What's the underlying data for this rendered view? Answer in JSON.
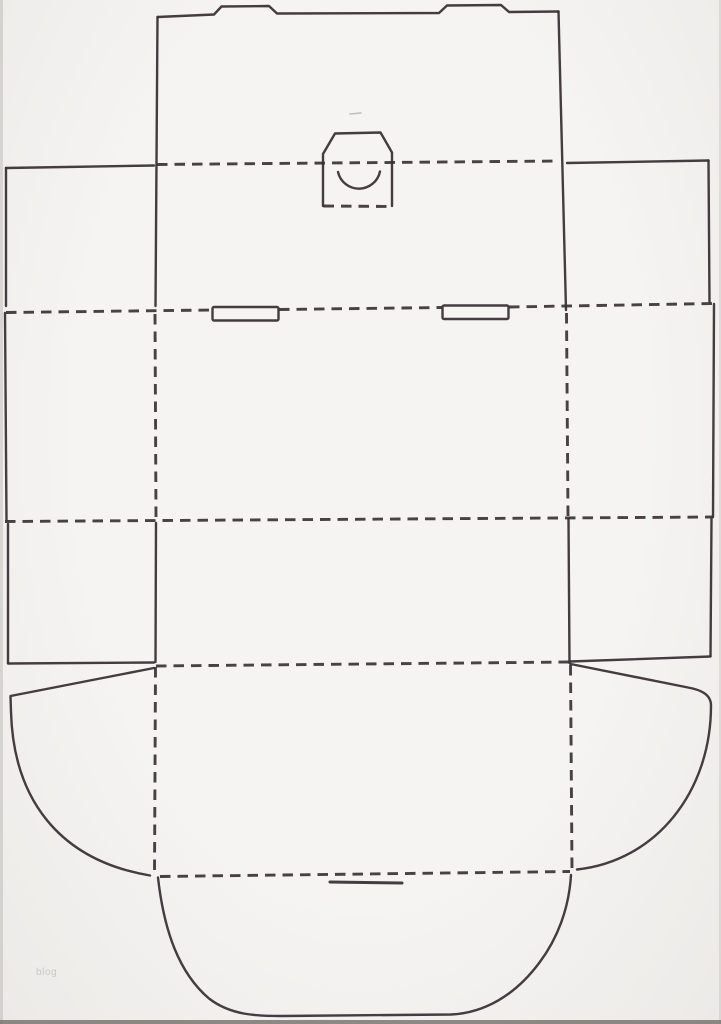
{
  "document": {
    "watermark_text": "blog",
    "colors": {
      "paper": "#f5f4f2",
      "paper_edge": "#eceae7",
      "ink": "#3a3136",
      "watermark": "#c9c6c4",
      "scan_band": "#6a6562"
    }
  }
}
